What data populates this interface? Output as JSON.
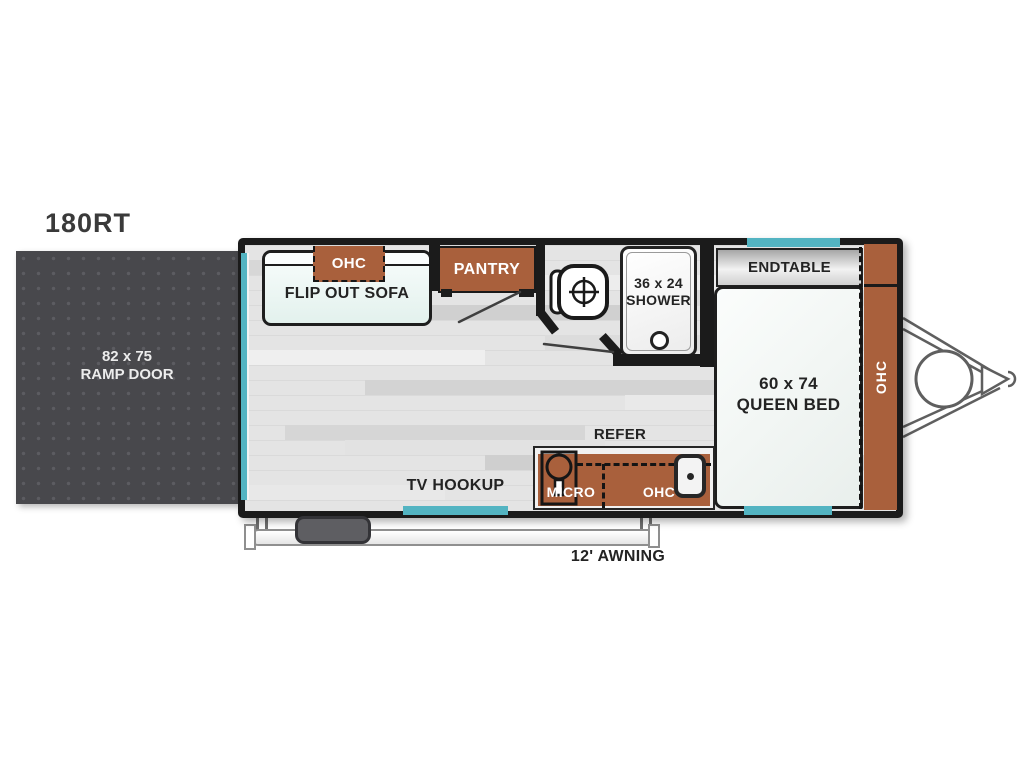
{
  "model_label": "180RT",
  "ramp_door": {
    "size": "82 x 75",
    "name": "RAMP DOOR"
  },
  "living": {
    "sofa_label": "FLIP OUT SOFA",
    "sofa_ohc_label": "OHC",
    "pantry_label": "PANTRY",
    "tv_hookup_label": "TV HOOKUP"
  },
  "bath": {
    "shower_size": "36 x 24",
    "shower_label": "SHOWER"
  },
  "bedroom": {
    "endtable_label": "ENDTABLE",
    "bed_size": "60 x 74",
    "bed_label": "QUEEN BED",
    "ohc_label": "OHC"
  },
  "kitchen": {
    "refer_label": "REFER",
    "micro_label": "MICRO",
    "ohc_label": "OHC"
  },
  "exterior": {
    "awning_label": "12' AWNING"
  },
  "colors": {
    "cabinet_brown": "#a9603c",
    "window_teal": "#53b4c2",
    "wall_black": "#1b1b1b"
  }
}
